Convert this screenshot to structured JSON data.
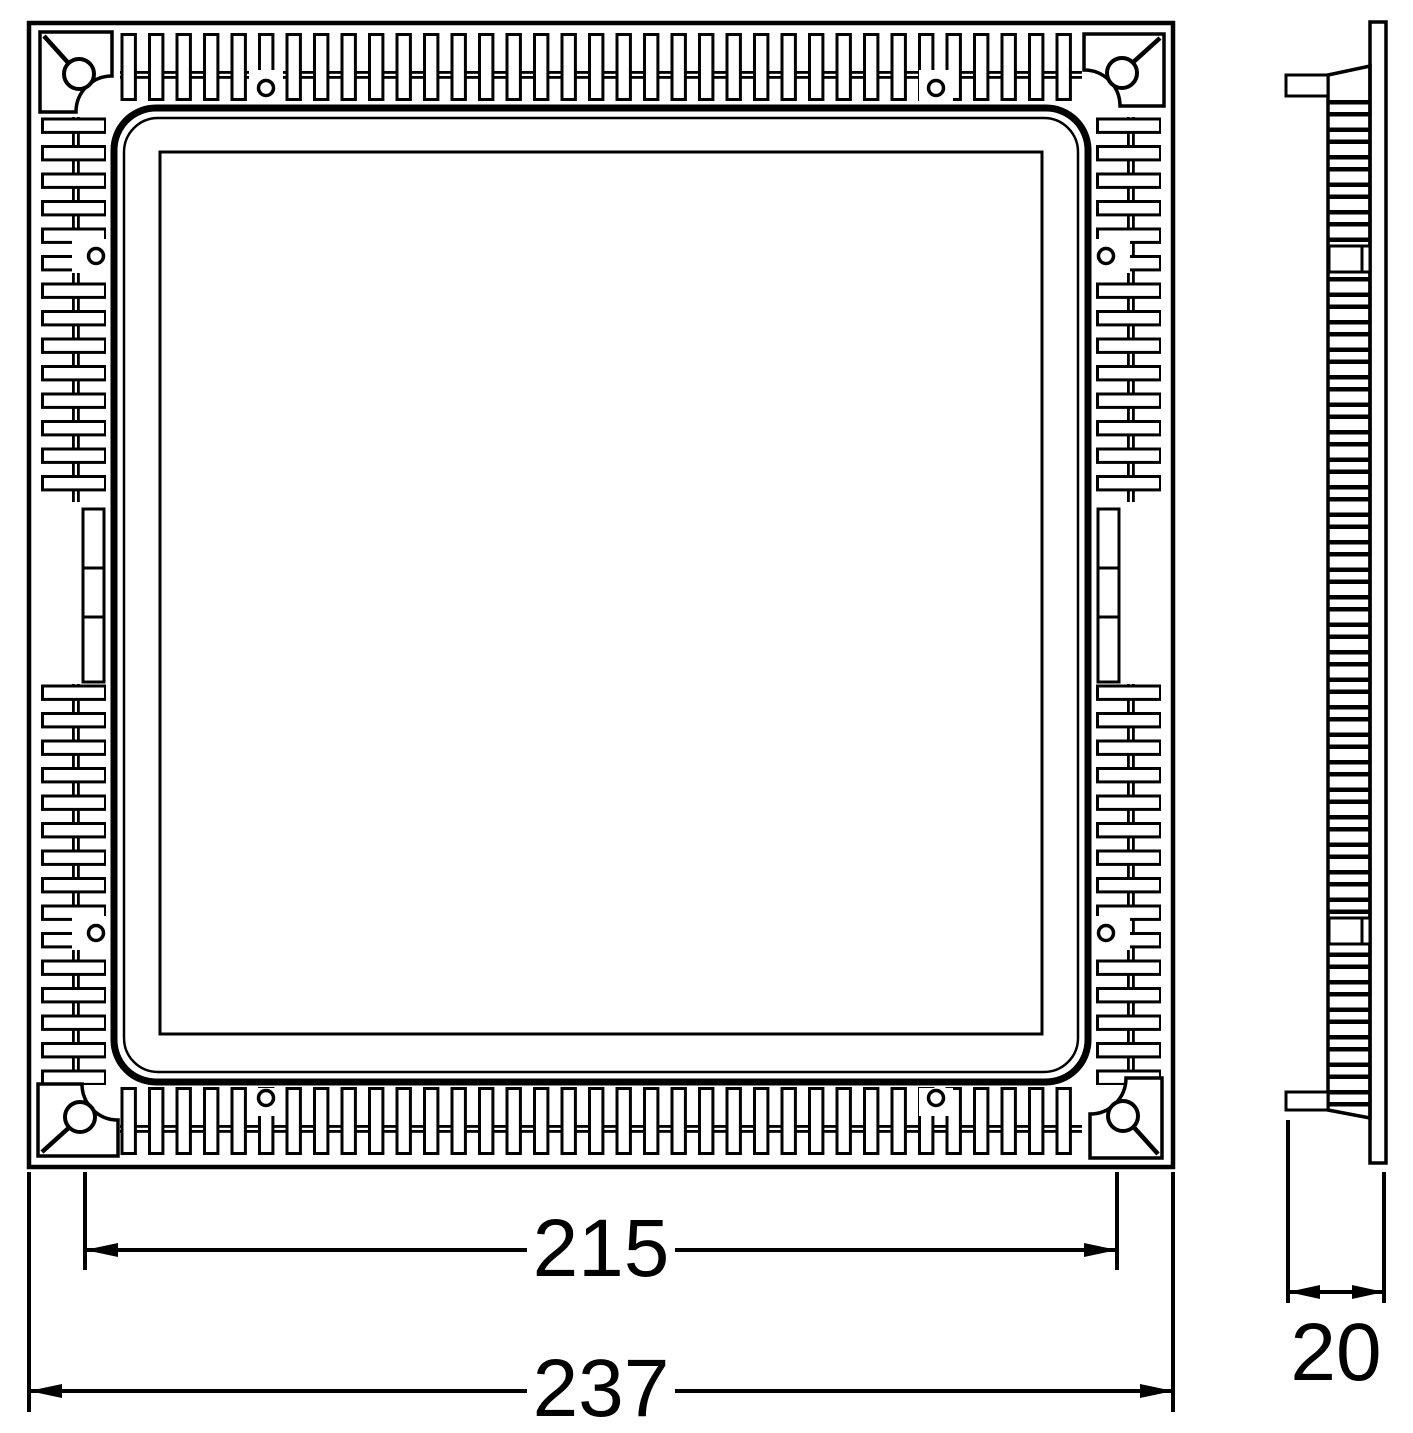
{
  "drawing": {
    "type": "technical-dimension-drawing",
    "background": "#ffffff",
    "line_color": "#000000",
    "views": {
      "front": {
        "shape": "square-panel-with-perimeter-fins"
      },
      "side": {
        "shape": "thin-profile-with-ribs"
      }
    },
    "dimensions": {
      "body_width": {
        "label": "215"
      },
      "overall_width": {
        "label": "237"
      },
      "depth": {
        "label": "20"
      }
    }
  }
}
